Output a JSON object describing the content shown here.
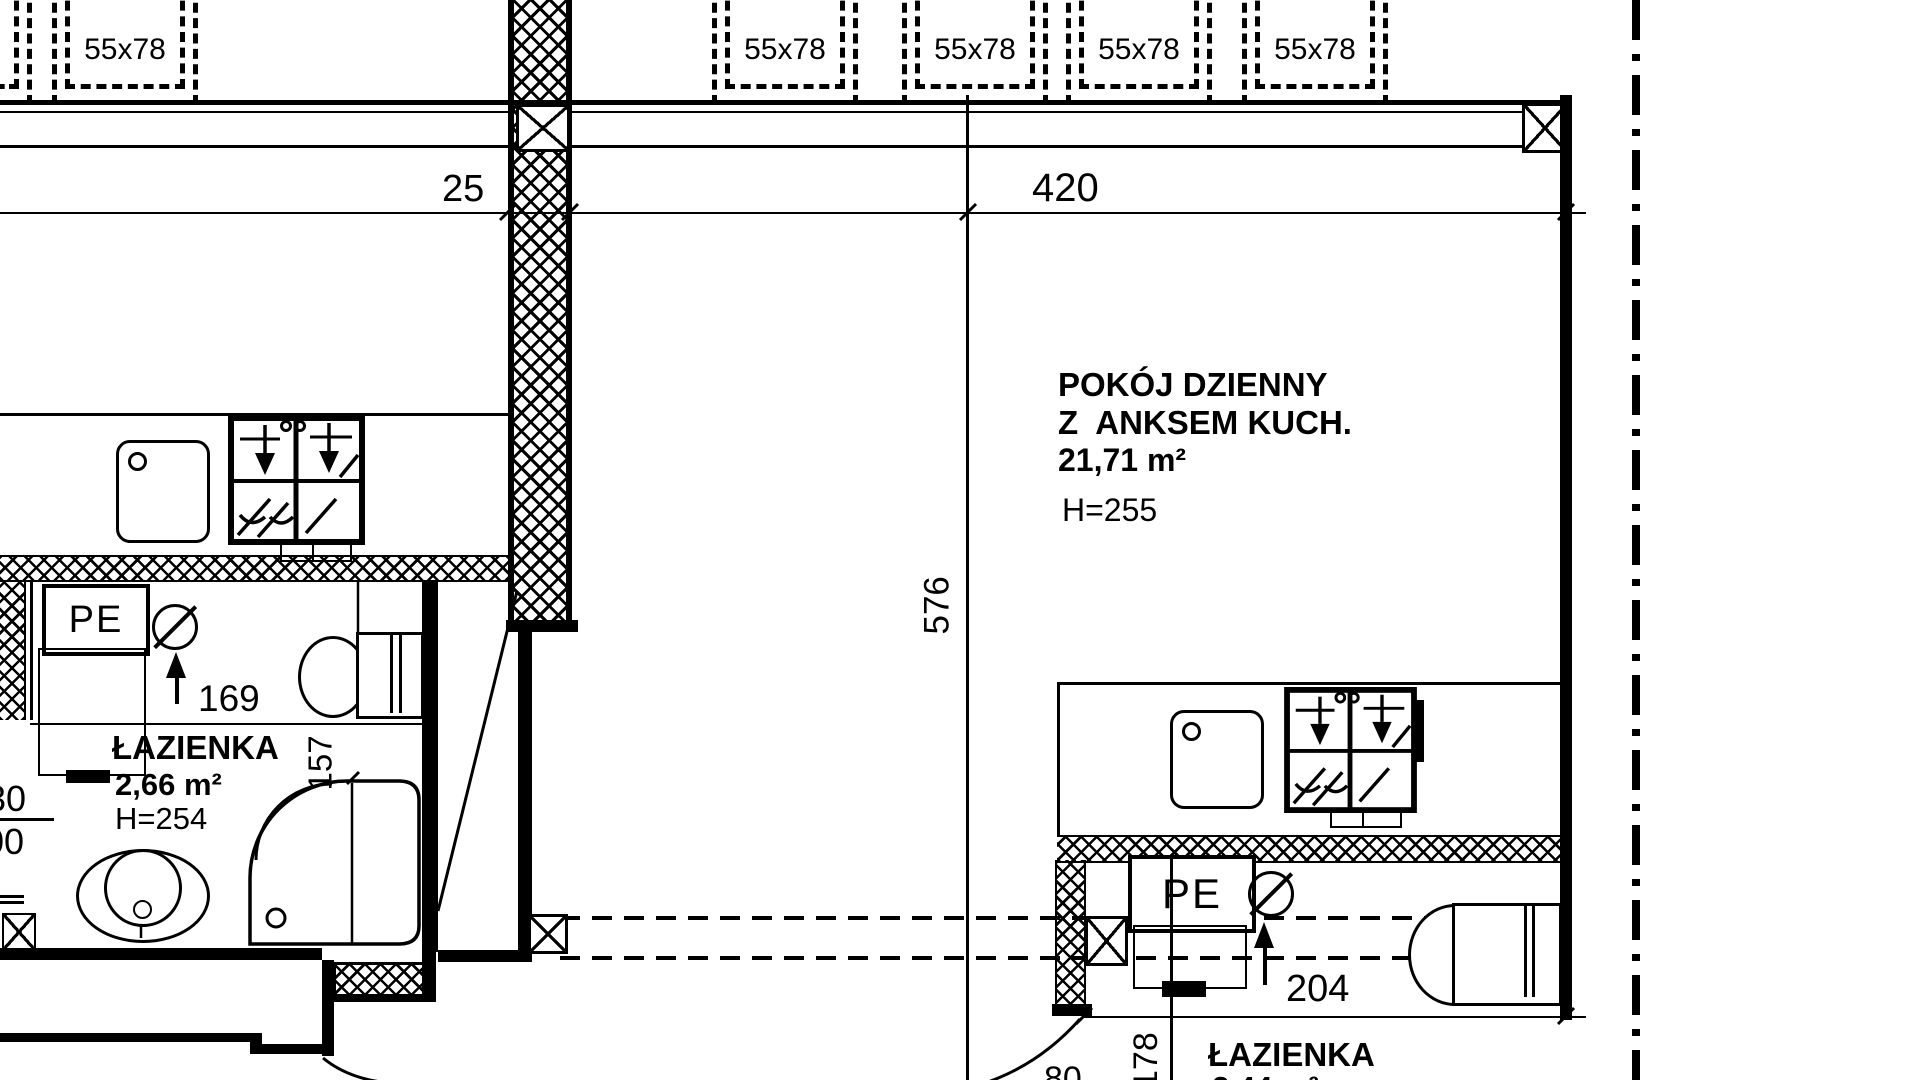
{
  "drawing": {
    "type": "floor-plan",
    "language": "pl"
  },
  "windows": {
    "items": [
      {
        "label": "55x78"
      },
      {
        "label": "55x78"
      },
      {
        "label": "55x78"
      },
      {
        "label": "55x78"
      },
      {
        "label": "55x78"
      }
    ]
  },
  "dimensions": {
    "d25": "25",
    "d420": "420",
    "d576": "576",
    "d169": "169",
    "d157": "157",
    "d204": "204",
    "d178": "178",
    "d30": "30",
    "d00": "00",
    "d80": "80"
  },
  "rooms": {
    "living": {
      "name_line1": "POKÓJ DZIENNY",
      "name_line2": "Z  ANKSEM KUCH.",
      "area": "21,71 m²",
      "height": "H=255"
    },
    "bath1": {
      "name": "ŁAZIENKA",
      "area": "2,66 m²",
      "height": "H=254"
    },
    "bath2": {
      "name": "ŁAZIENKA",
      "area": "2,44 m²"
    }
  },
  "labels": {
    "pe": "PE"
  }
}
